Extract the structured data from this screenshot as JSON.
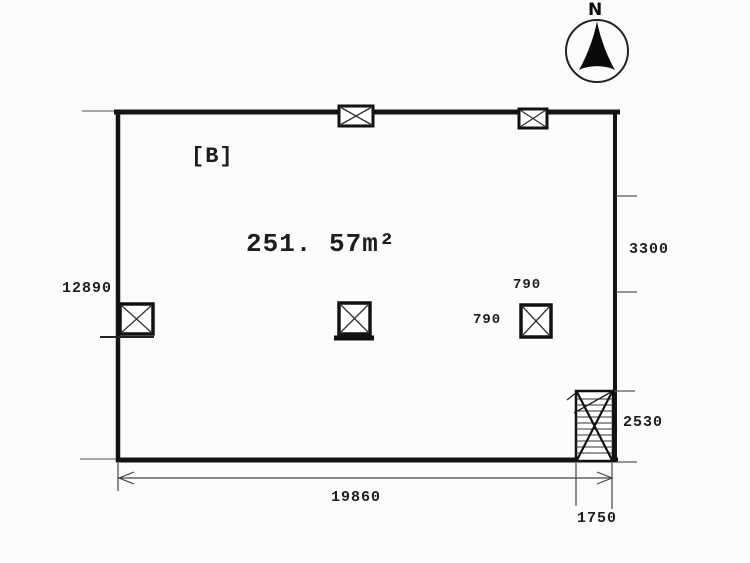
{
  "compass": {
    "label": "N"
  },
  "plan": {
    "room_label": "[B]",
    "area_label": "251. 57m²"
  },
  "dimensions": {
    "left_side": "12890",
    "right_upper": "3300",
    "column_top": "790",
    "column_left": "790",
    "stair_height": "2530",
    "bottom_width": "19860",
    "stair_width": "1750"
  },
  "colors": {
    "line": "#141414",
    "thin_line": "#555555",
    "background": "#fcfcfb"
  }
}
